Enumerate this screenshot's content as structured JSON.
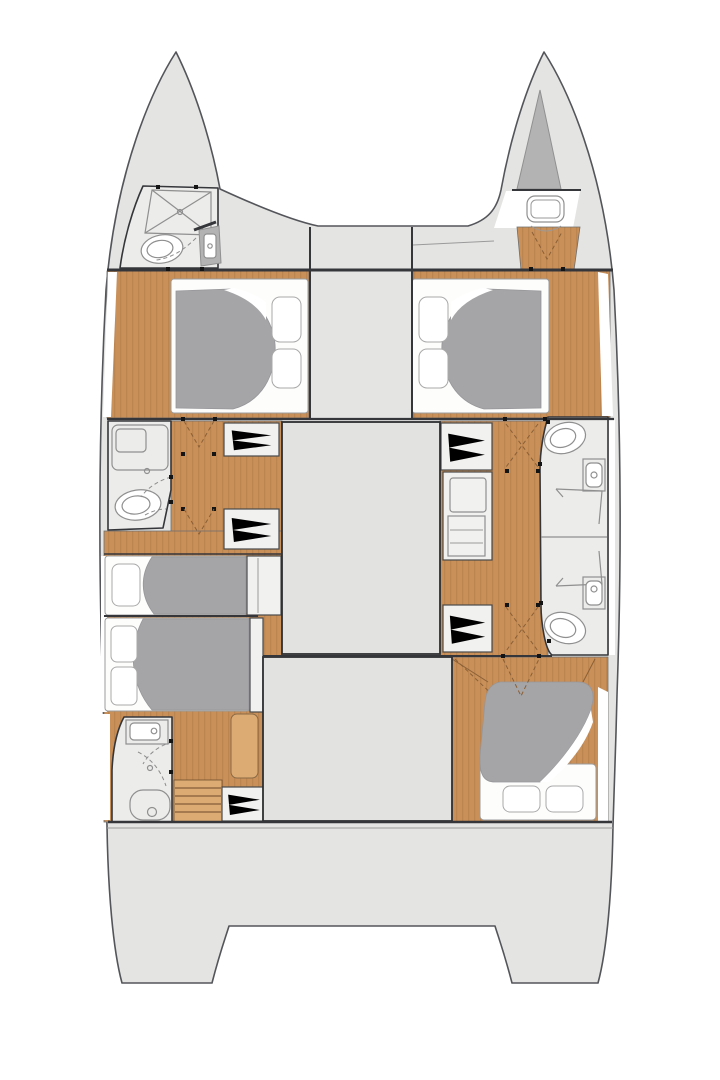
{
  "meta": {
    "title": "Catamaran interior layout — top-view floor plan",
    "type": "boat floor plan",
    "view": "overhead"
  },
  "colors": {
    "hull": "#e4e4e3",
    "hullStroke": "#54555a",
    "room": "#ececeb",
    "block": "#e2e2e1",
    "blockStroke": "#2d2e30",
    "wood": "#c9905a",
    "woodDark": "#b87f4b",
    "woodLight": "#dcab74",
    "blanket": "#a5a5a7",
    "locker": "#b3b3b3",
    "mattress": "#fdfdfc",
    "wall": "#35363a",
    "furnStroke": "#8f8f8f",
    "dashLight": "#8d8d8d",
    "dashWood": "#8a6036",
    "dot": "#141414"
  },
  "legend": {
    "hulls": [
      "port",
      "starboard"
    ],
    "areas": [
      {
        "id": "foredeck",
        "label": "Foredeck between bows"
      },
      {
        "id": "port-bow-head",
        "label": "Bow bathroom (port)",
        "fixtures": [
          "shower pan",
          "toilet",
          "washbasin unit"
        ]
      },
      {
        "id": "starboard-bow",
        "label": "Bow locker (starboard)",
        "fixtures": [
          "anchor locker",
          "deck hatch",
          "forepeak floor"
        ]
      },
      {
        "id": "port-forward-cabin",
        "label": "Forward double cabin (port)",
        "fixtures": [
          "double berth",
          "2 pillows",
          "blanket"
        ]
      },
      {
        "id": "starboard-forward-cabin",
        "label": "Forward double cabin (starboard)",
        "fixtures": [
          "double berth",
          "2 pillows",
          "blanket"
        ]
      },
      {
        "id": "port-mid-head",
        "label": "Midship bathroom (port)",
        "fixtures": [
          "shower",
          "toilet"
        ]
      },
      {
        "id": "port-corridor",
        "label": "Companionway & wardrobes (port)",
        "fixtures": [
          "2 hanging lockers"
        ]
      },
      {
        "id": "starboard-corridor",
        "label": "Companionway & wardrobes (starboard)",
        "fixtures": [
          "2 hanging lockers",
          "appliance cabinet"
        ]
      },
      {
        "id": "starboard-mid-heads",
        "label": "Twin bathrooms (starboard)",
        "fixtures": [
          "2 toilets",
          "2 washbasins",
          "2 shower stalls"
        ]
      },
      {
        "id": "port-mid-berth",
        "label": "Midship berth (port)",
        "fixtures": [
          "berth",
          "pillow",
          "blanket"
        ]
      },
      {
        "id": "port-aft-cabin",
        "label": "Aft cabin (port)",
        "fixtures": [
          "double berth",
          "2 pillows",
          "blanket"
        ]
      },
      {
        "id": "port-aft-head",
        "label": "Aft bathroom (port)",
        "fixtures": [
          "washbasin",
          "shower",
          "toilet",
          "companionway steps",
          "seat",
          "wardrobe"
        ]
      },
      {
        "id": "starboard-aft-cabin",
        "label": "Aft cabin (starboard)",
        "fixtures": [
          "double berth",
          "2 pillows",
          "blanket"
        ]
      },
      {
        "id": "bridgedeck",
        "label": "Bridgedeck / saloon structures"
      },
      {
        "id": "transoms",
        "label": "Twin transom steps"
      }
    ],
    "symbols": [
      {
        "icon": "door-dot",
        "meaning": "door opening mark"
      },
      {
        "icon": "dashed-arc",
        "meaning": "door swing"
      },
      {
        "icon": "zigzag",
        "meaning": "wardrobe hanging rail"
      },
      {
        "icon": "x-square",
        "meaning": "shower pan"
      }
    ]
  }
}
